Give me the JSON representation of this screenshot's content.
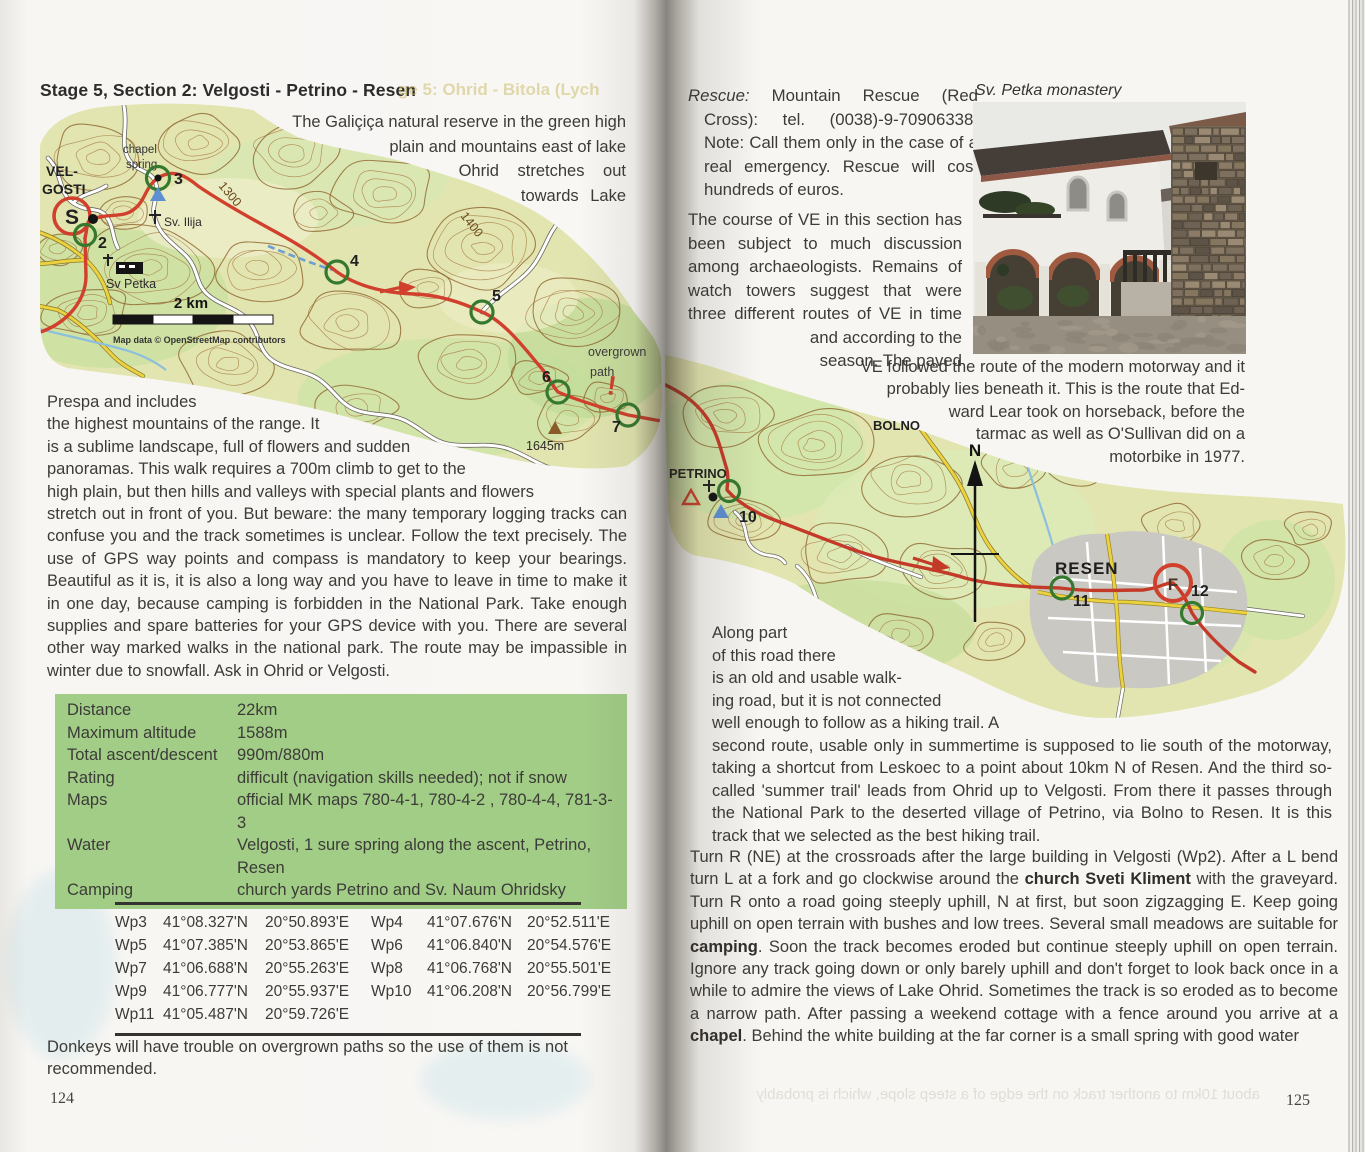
{
  "left_page": {
    "title": "Stage 5, Section 2: Velgosti - Petrino - Resen",
    "ghost_title": "ge 5: Ohrid - Bitola (Lych",
    "intro_lines": [
      "The Galiçiça natural reserve in the green high",
      "plain and mountains east of lake",
      "Ohrid stretches out",
      "towards Lake"
    ],
    "body_lines": [
      "Prespa and includes",
      "the highest mountains of the range. It",
      "is a sublime landscape, full of flowers and sudden",
      "panoramas. This walk requires a 700m climb to get to the",
      "high plain, but then hills and valleys with special plants and flowers"
    ],
    "body_rest": "stretch out in front of you. But beware: the many temporary logging tracks can confuse you and the track sometimes is unclear. Follow the text precisely. The use of GPS way points and compass is mandatory to keep your bearings. Beautiful as it is, it is also a long way and you have to leave in time to make it in one day, because camping is forbidden in the National Park. Take enough supplies and spare batteries for your GPS device with you. There are several other way marked walks in the national park. The route may be impassible in winter due to snowfall. Ask in Ohrid or Velgosti.",
    "info": [
      {
        "label": "Distance",
        "value": "22km"
      },
      {
        "label": "Maximum altitude",
        "value": "1588m"
      },
      {
        "label": "Total ascent/descent",
        "value": "990m/880m"
      },
      {
        "label": "Rating",
        "value": "difficult (navigation skills needed); not if snow"
      },
      {
        "label": "Maps",
        "value": "official MK maps 780-4-1, 780-4-2 , 780-4-4, 781-3-3"
      },
      {
        "label": "Water",
        "value": "Velgosti, 1 sure spring along the ascent, Petrino, Resen"
      },
      {
        "label": "Camping",
        "value": "church yards Petrino and Sv. Naum Ohridsky"
      }
    ],
    "waypoints": [
      [
        "Wp3",
        "41°08.327'N",
        "20°50.893'E",
        "Wp4",
        "41°07.676'N",
        "20°52.511'E"
      ],
      [
        "Wp5",
        "41°07.385'N",
        "20°53.865'E",
        "Wp6",
        "41°06.840'N",
        "20°54.576'E"
      ],
      [
        "Wp7",
        "41°06.688'N",
        "20°55.263'E",
        "Wp8",
        "41°06.768'N",
        "20°55.501'E"
      ],
      [
        "Wp9",
        "41°06.777'N",
        "20°55.937'E",
        "Wp10",
        "41°06.208'N",
        "20°56.799'E"
      ],
      [
        "Wp11",
        "41°05.487'N",
        "20°59.726'E",
        "",
        "",
        ""
      ]
    ],
    "note": "Donkeys will have trouble on overgrown paths so the use of them is not recommended.",
    "page_number": "124",
    "map": {
      "velgosti_1": "VEL-",
      "velgosti_2": "GOSTI",
      "chapel": "chapel",
      "spring": "spring",
      "sv_ilija": "Sv. Ilija",
      "sv_petka": "Sv Petka",
      "c1300": "1300",
      "c1400": "1400",
      "start": "S",
      "wp2": "2",
      "wp3": "3",
      "wp4": "4",
      "wp5": "5",
      "wp6": "6",
      "wp7": "7",
      "overgrown_1": "overgrown",
      "overgrown_2": "path",
      "warn": "!",
      "peak": "1645m",
      "scale": "2 km",
      "attribution": "Map data © OpenStreetMap contributors"
    }
  },
  "right_page": {
    "rescue_lead": "Rescue:",
    "rescue_rest": " Mountain Rescue (Red Cross): tel. (0038)-9-70906338. Note: Call them only in the case of a real emergency. Rescue will cost hundreds of euros.",
    "course_lines": [
      "The course of VE in this section has",
      "been subject to much discussion",
      "among archaeologists. Remains of",
      "watch towers suggest that were",
      "three different routes of VE in time",
      "and according to the",
      "season. The paved"
    ],
    "photo_caption": "Sv. Petka monastery",
    "ve_lines": [
      "VE followed the route of the modern motorway and it",
      "probably lies beneath it. This is the route that Ed-",
      "ward Lear took on horseback, before the",
      "tarmac as well as O'Sullivan did on a",
      "motorbike in 1977."
    ],
    "along_lines": [
      "Along part",
      "of this road there",
      "is an old and usable walk-",
      "ing road, but it is not connected",
      "well enough to follow as a hiking trail. A"
    ],
    "along_rest": "second route, usable only in summertime is supposed to lie south of the motorway, taking a shortcut from Leskoec to a point about 10km N of Resen. And the third so-called 'summer trail' leads from Ohrid up to Velgosti. From there it passes through the National Park to the deserted village of Petrino, via Bolno to Resen. It is this track that we selected as the best hiking trail.",
    "final": {
      "s0": "Turn R (NE) at the crossroads after the large building in Velgosti (Wp2). After a L bend turn L at a fork and go clockwise around the ",
      "s1": "church Sveti Kliment",
      "s2": " with the graveyard. Turn R onto a road going steeply uphill, N at first, but soon zigzagging E. Keep going uphill on open terrain with bushes and low trees. Several small meadows are suitable for ",
      "s3": "camping",
      "s4": ". Soon the track becomes eroded but continue steeply uphill on open terrain. Ignore any track going down or only barely uphill and don't forget to look back once in a while to admire the views of Lake Ohrid. Sometimes the track is so eroded as to become a narrow path. After passing a weekend cottage with a fence around you arrive at a ",
      "s5": "chapel",
      "s6": ". Behind the white building at the far corner is a small spring with good water"
    },
    "ghost_bottom": "about 10km to another track on the edge of a steep slope, which is probably",
    "page_number": "125",
    "map": {
      "bolno": "BOLNO",
      "north": "N",
      "petrino": "PETRINO",
      "wp10": "10",
      "resen": "RESEN",
      "wp11": "11",
      "finish": "F",
      "wp12": "12"
    }
  }
}
